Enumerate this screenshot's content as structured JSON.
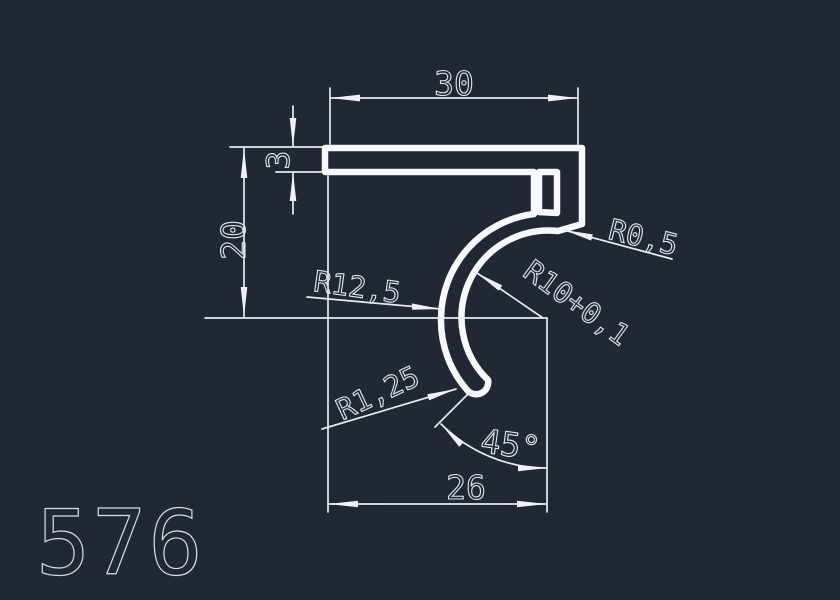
{
  "title": {
    "part_number": "576"
  },
  "colors": {
    "background": "#212733",
    "profile_line": "#f7f9fc",
    "dimension_line": "#e6ebf3",
    "dimension_text": "#dfe6f0"
  },
  "dimensions": {
    "top_width": "30",
    "wall_thickness": "3",
    "height": "20",
    "bottom_width": "26",
    "tip_angle": "45°",
    "outer_radius": "R12,5",
    "inner_radius": "R10+0,1",
    "corner_radius": "R0,5",
    "tip_radius": "R1,25"
  }
}
